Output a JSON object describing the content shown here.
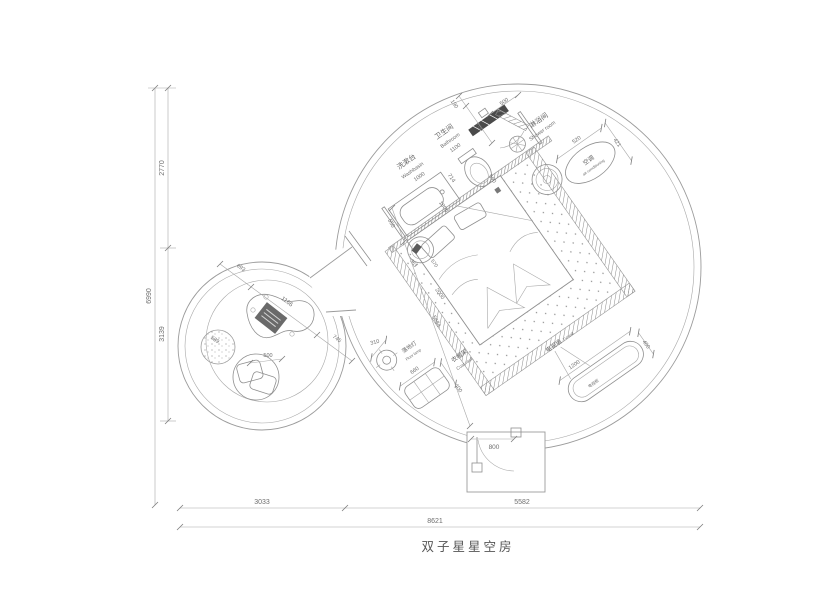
{
  "drawing": {
    "title": "双子星星空房"
  },
  "labels": {
    "washbasin": {
      "cn": "洗漱台",
      "en": "Washbasin"
    },
    "bathroom": {
      "cn": "卫生间",
      "en": "Bathroom"
    },
    "shower": {
      "cn": "淋浴间",
      "en": "Shower room"
    },
    "ac": {
      "cn": "空调",
      "en": "air-conditioning"
    },
    "tv_wall": {
      "cn": "电视墙",
      "en": "TV wall"
    },
    "tv_cabinet": {
      "cn": "电视柜"
    },
    "coat_rack": {
      "cn": "衣帽架",
      "en": "Coat rack"
    },
    "floor_lamp": {
      "cn": "落地灯",
      "en": "Floor lamp"
    }
  },
  "dims": {
    "total_height": "6990",
    "upper_height": "2770",
    "lower_height": "3139",
    "left_width": "3033",
    "right_width": "5582",
    "total_width": "8621",
    "entry_door": "800",
    "washbasin_w": "1000",
    "bathroom_w": "1100",
    "counter_depth": "550",
    "toilet_w": "714",
    "shower_door": "500",
    "bath_door": "700",
    "wall_seg": "190",
    "niche": "590",
    "bed_w": "1800",
    "bed_l": "2000",
    "room_diag": "5684",
    "stool_a": "363",
    "stool_b": "570",
    "ac_w": "520",
    "ac_d": "421",
    "tv_w": "1200",
    "tv_d": "400",
    "rack_w": "660",
    "rack_d": "400",
    "lamp_d": "310",
    "tea_a": "693",
    "tea_table": "1166",
    "tea_b": "745",
    "pouf_d": "589",
    "chair_d": "500"
  },
  "colors": {
    "line": "#9b9b9b",
    "text": "#6e6e6e",
    "dark": "#4a4a4a"
  }
}
